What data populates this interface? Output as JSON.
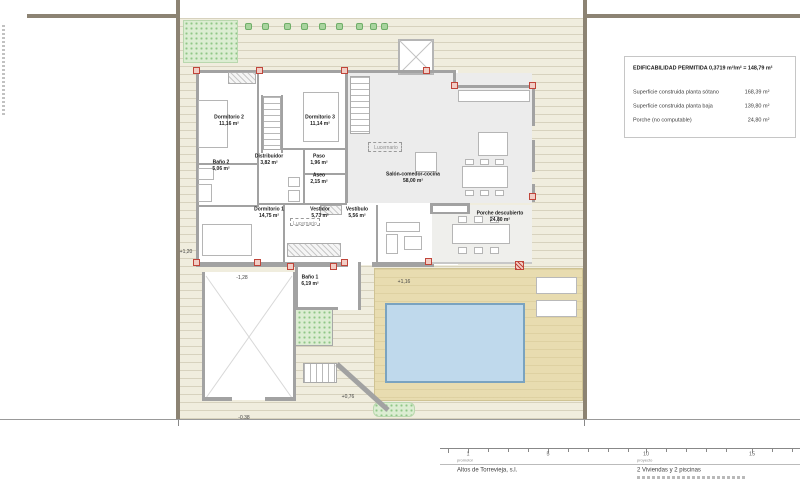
{
  "info_box": {
    "title": "EDIFICABILIDAD PERMITIDA 0,3719 m²/m² = 148,79 m²",
    "rows": [
      {
        "label": "Superficie construida planta sótano",
        "value": "168,39 m²"
      },
      {
        "label": "Superficie construida planta baja",
        "value": "139,80 m²"
      },
      {
        "label": "Porche (no computable)",
        "value": "24,80 m²"
      }
    ]
  },
  "rooms": [
    {
      "name": "Dormitorio 2",
      "area": "11,16 m²"
    },
    {
      "name": "Dormitorio 3",
      "area": "11,14 m²"
    },
    {
      "name": "Baño 2",
      "area": "5,06 m²"
    },
    {
      "name": "Distribuidor",
      "area": "3,82 m²"
    },
    {
      "name": "Paso",
      "area": "1,96 m²"
    },
    {
      "name": "Aseo",
      "area": "2,15 m²"
    },
    {
      "name": "Dormitorio 1",
      "area": "14,75 m²"
    },
    {
      "name": "Vestidor",
      "area": "5,73 m²"
    },
    {
      "name": "Vestíbulo",
      "area": "5,56 m²"
    },
    {
      "name": "Salón-comedor-cocina",
      "area": "58,00 m²"
    },
    {
      "name": "Porche descubierto",
      "area": "24,80 m²"
    },
    {
      "name": "Baño 1",
      "area": "6,19 m²"
    }
  ],
  "annotations": {
    "lucernario": "Lucernario",
    "level_plus_120": "+1,20",
    "level_minus_128": "-1,28",
    "level_plus_116": "+1,16",
    "level_plus_076": "+0,76",
    "level_minus_038": "-0,38"
  },
  "title_block": {
    "promotor_label": "promotor",
    "promotor_value": "Altos de Torrevieja, s.l.",
    "proyecto_label": "proyecto",
    "proyecto_value": "2 Viviendas y 2 piscinas",
    "scale_ticks": [
      "1",
      "5",
      "10",
      "15"
    ]
  },
  "colors": {
    "boundary": "#8c8373",
    "terrace": "#f0edde",
    "pool_water": "#bfd9ec",
    "pool_border": "#7aa3c0",
    "pool_deck": "#e8dcb0",
    "vegetation": "#dcedd2",
    "column_accent": "#c0453a",
    "wall": "#a2a2a2"
  }
}
